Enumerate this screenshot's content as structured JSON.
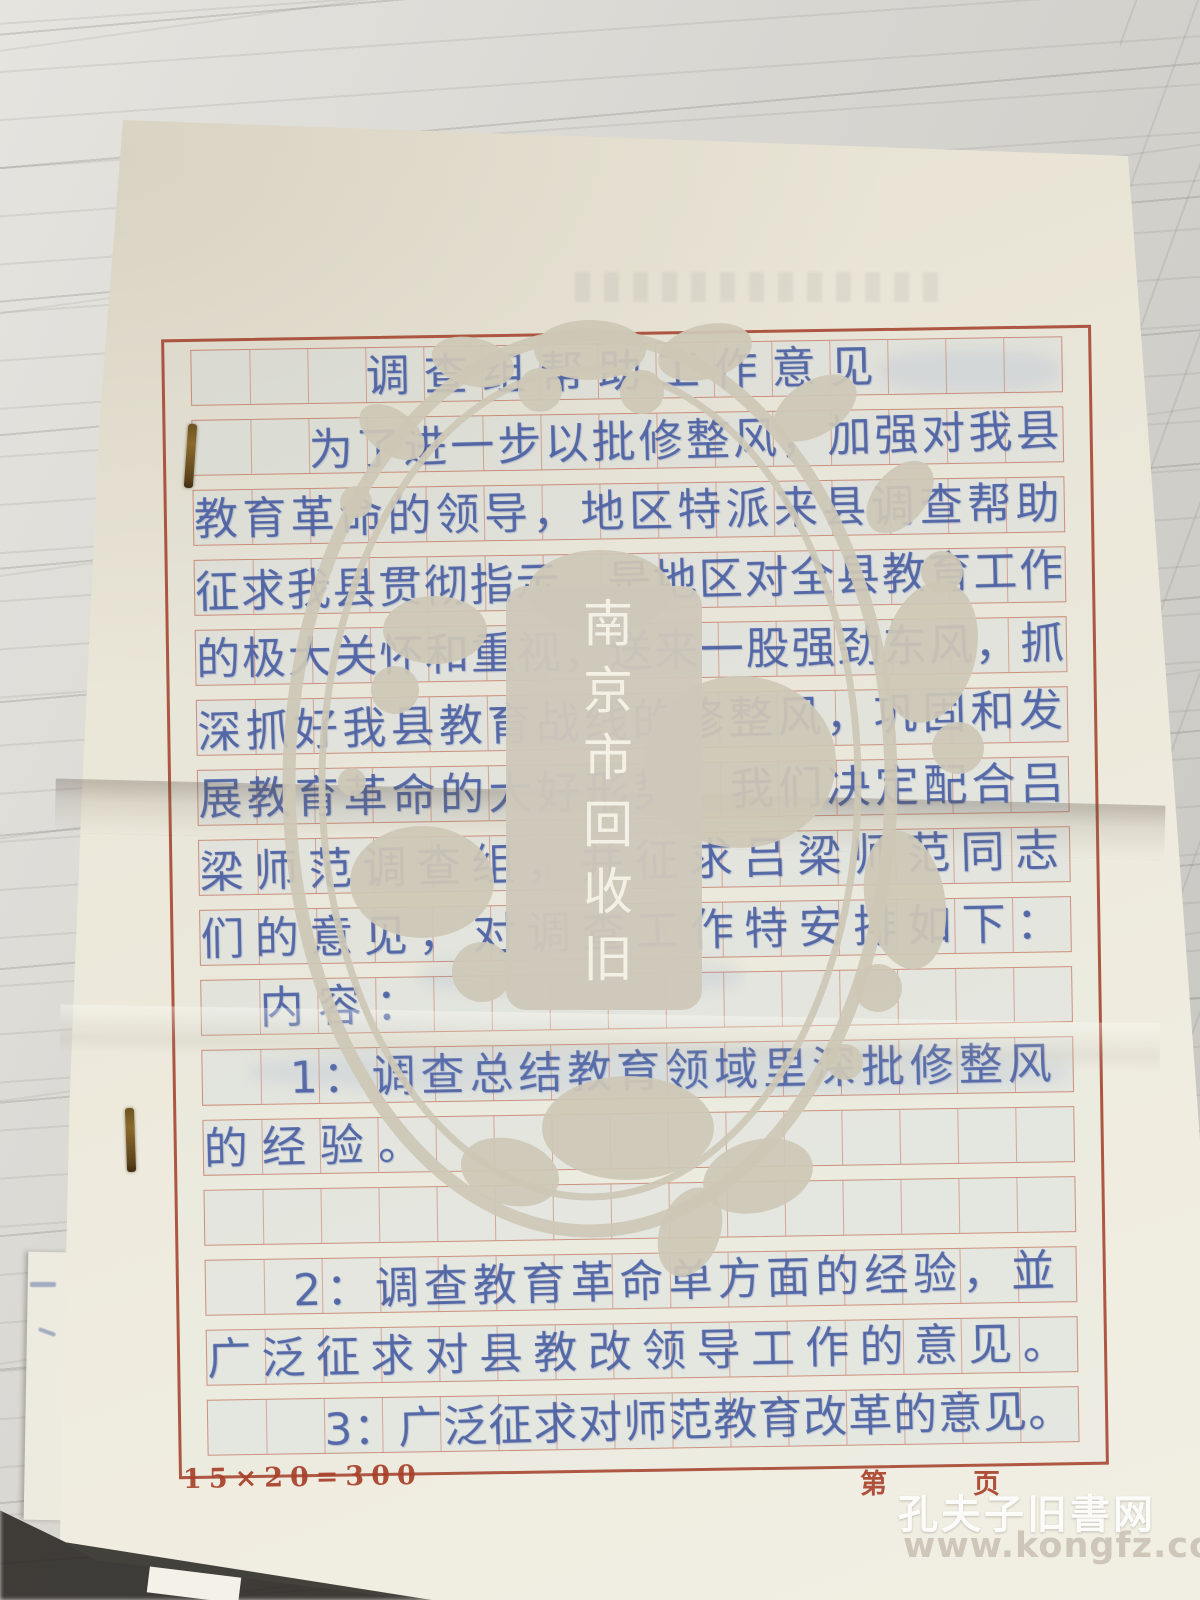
{
  "photo": {
    "manuscript": {
      "lines": [
        {
          "text": "调查组帮助工作意见",
          "indent": 3
        },
        {
          "text": "为了进一步以批修整风，加强对我县",
          "indent": 2
        },
        {
          "text": "教育革命的领导，地区特派来县调查帮助",
          "indent": 0
        },
        {
          "text": "征求我县贯彻指示，是地区对全县教育工作",
          "indent": 0
        },
        {
          "text": "的极大关怀和重视，送来一股强劲东风，抓",
          "indent": 0
        },
        {
          "text": "深抓好我县教育战线的修整风，巩固和发",
          "indent": 0
        },
        {
          "text": "展教育革命的大好形势，我们决定配合吕",
          "indent": 0
        },
        {
          "text": "梁师范调查组，并征求吕梁师范同志",
          "indent": 0
        },
        {
          "text": "们的意见，对调查工作特安排如下：",
          "indent": 0
        },
        {
          "text": "内容：",
          "indent": 1
        },
        {
          "text": "1：调查总结教育领域里深批修整风",
          "indent": 1.5
        },
        {
          "text": "的经验。",
          "indent": 0
        },
        {
          "text": "",
          "indent": 0
        },
        {
          "text": "2：调查教育革命单方面的经验，並",
          "indent": 1.5
        },
        {
          "text": "广泛征求对县教改领导工作的意见。",
          "indent": 0
        },
        {
          "text": "3：广泛征求对师范教育改革的意见。",
          "indent": 2
        }
      ],
      "paper_spec_label": "15×20=300",
      "page_label_first": "第",
      "page_label_second": "页"
    },
    "watermarks": {
      "oval_vertical_text": "南京市回收旧",
      "site_name": "孔夫子旧書网",
      "site_url": "www.kongfz.com"
    },
    "colors": {
      "grid_red": "#a8402a",
      "ink_blue": "#3d549e",
      "watermark_beige": "#cec7b6",
      "paper_cream": "#ece8da"
    }
  }
}
